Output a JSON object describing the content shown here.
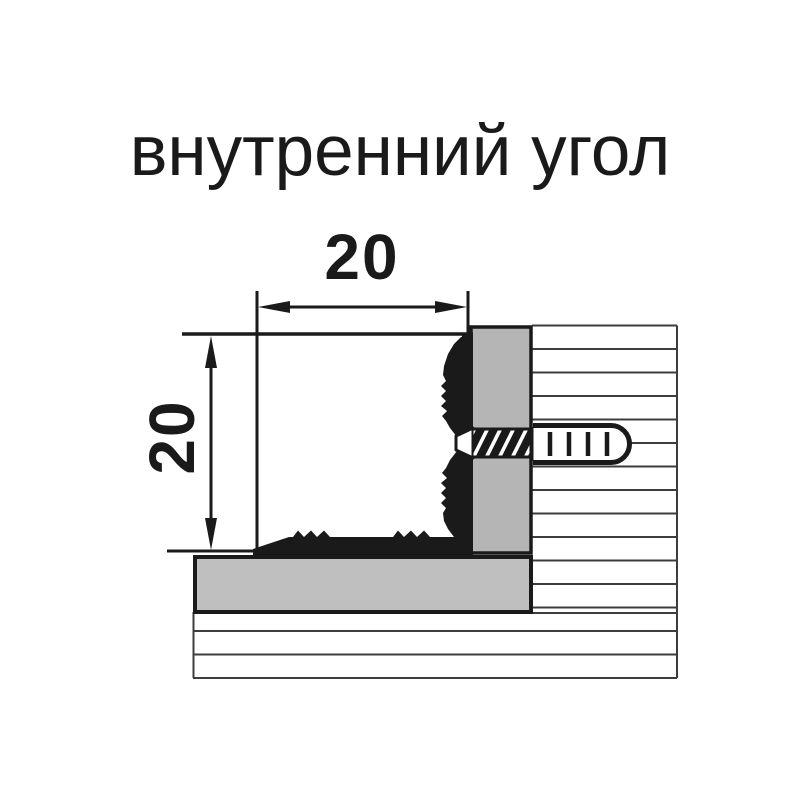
{
  "title": "внутренний угол",
  "dimensions": {
    "width": "20",
    "height": "20"
  },
  "colors": {
    "ink": "#1a1a1a",
    "wall_line": "#3d3d3d",
    "floor_panel_gray": "#bfbfbf",
    "wall_bar_gray": "#b5b5b5",
    "background": "#ffffff"
  }
}
